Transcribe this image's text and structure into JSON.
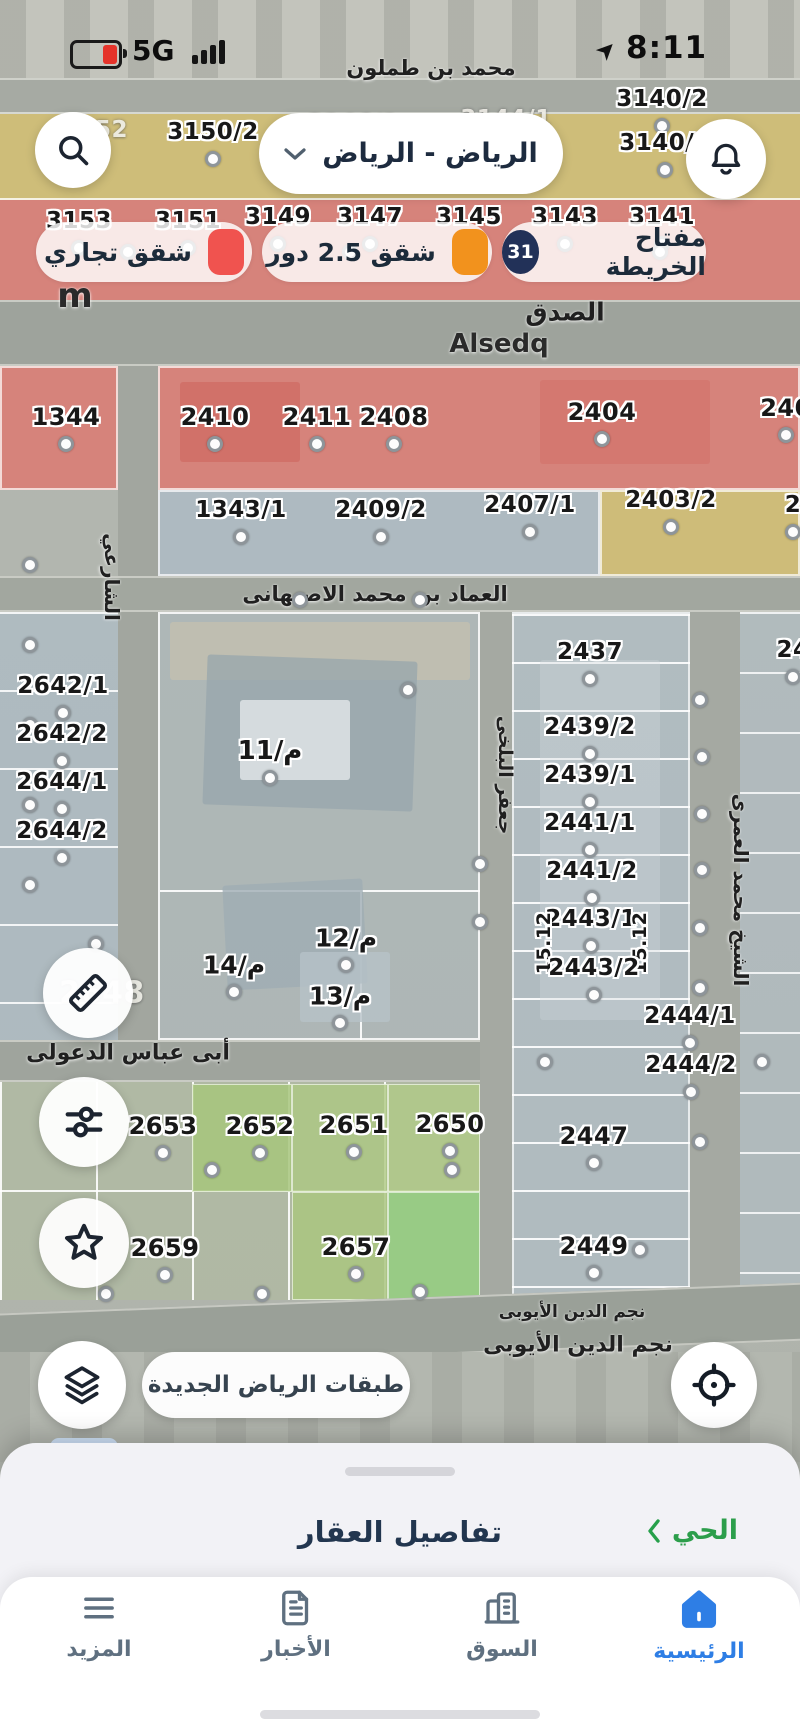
{
  "status_bar": {
    "time": "8:11",
    "network": "5G"
  },
  "header": {
    "city_selector": "الرياض - الرياض"
  },
  "legend": {
    "items": [
      {
        "label": "شقق تجاري",
        "color": "#f0534f"
      },
      {
        "label": "شقق 2.5 دور",
        "color": "#f2921d"
      }
    ],
    "map_key_label": "مفتاح الخريطة",
    "map_key_count": "31"
  },
  "colors": {
    "accent_blue": "#2e7ee5",
    "link_green": "#2c9e4b",
    "map_key_navy": "#223158"
  },
  "floating": {
    "layers_badge": "جديد",
    "layers_pill": "طبقات الرياض الجديدة"
  },
  "bottom_sheet": {
    "title": "تفاصيل العقار",
    "link": "الحي"
  },
  "bottom_nav": {
    "items": [
      {
        "id": "more",
        "label": "المزيد",
        "active": false
      },
      {
        "id": "news",
        "label": "الأخبار",
        "active": false
      },
      {
        "id": "market",
        "label": "السوق",
        "active": false
      },
      {
        "id": "home",
        "label": "الرئيسية",
        "active": true
      }
    ]
  },
  "map": {
    "street_labels": [
      {
        "t": "محمد بن طملون",
        "x": 431,
        "y": 68,
        "s": 21
      },
      {
        "t": "الصدق",
        "x": 565,
        "y": 312,
        "s": 25
      },
      {
        "t": "Alsedq",
        "x": 499,
        "y": 344,
        "s": 26,
        "latin": 1
      },
      {
        "t": "العماد بن محمد الاصبهانى",
        "x": 375,
        "y": 594,
        "s": 21
      },
      {
        "t": "الشارعي",
        "x": 112,
        "y": 577,
        "s": 20,
        "r": 90
      },
      {
        "t": "جعفر البلخى",
        "x": 505,
        "y": 775,
        "s": 19,
        "r": 90
      },
      {
        "t": "الشيخ محمد العمرى",
        "x": 741,
        "y": 890,
        "s": 20,
        "r": 90
      },
      {
        "t": "أبى عباس الدعولى",
        "x": 128,
        "y": 1053,
        "s": 22
      },
      {
        "t": "نجم الدين الأيوبى",
        "x": 572,
        "y": 1312,
        "s": 17
      },
      {
        "t": "نجم الدين الأيوبى",
        "x": 578,
        "y": 1345,
        "s": 22
      },
      {
        "t": "m",
        "x": 75,
        "y": 296,
        "s": 34,
        "latin": 1
      }
    ],
    "parcel_labels": [
      {
        "t": "3152",
        "x": 95,
        "y": 130,
        "k": "g"
      },
      {
        "t": "3150/2",
        "x": 213,
        "y": 132
      },
      {
        "t": "3146/1",
        "x": 353,
        "y": 124,
        "k": "g"
      },
      {
        "t": "3144/1",
        "x": 506,
        "y": 119,
        "k": "g"
      },
      {
        "t": "3140/2",
        "x": 662,
        "y": 99
      },
      {
        "t": "3140/1",
        "x": 665,
        "y": 143
      },
      {
        "t": "3153",
        "x": 79,
        "y": 221
      },
      {
        "t": "3151",
        "x": 188,
        "y": 221
      },
      {
        "t": "3149",
        "x": 278,
        "y": 217
      },
      {
        "t": "3147",
        "x": 370,
        "y": 217
      },
      {
        "t": "3145",
        "x": 469,
        "y": 217
      },
      {
        "t": "3143",
        "x": 565,
        "y": 217
      },
      {
        "t": "3141",
        "x": 662,
        "y": 217
      },
      {
        "t": "1344",
        "x": 66,
        "y": 417,
        "s": 24
      },
      {
        "t": "2410",
        "x": 215,
        "y": 417,
        "s": 24
      },
      {
        "t": "2411",
        "x": 317,
        "y": 417,
        "s": 24
      },
      {
        "t": "2408",
        "x": 394,
        "y": 417,
        "s": 24
      },
      {
        "t": "2404",
        "x": 602,
        "y": 412,
        "s": 24
      },
      {
        "t": "240",
        "x": 786,
        "y": 408,
        "s": 24
      },
      {
        "t": "1343/1",
        "x": 241,
        "y": 510
      },
      {
        "t": "2409/2",
        "x": 381,
        "y": 510
      },
      {
        "t": "2407/1",
        "x": 530,
        "y": 505
      },
      {
        "t": "2403/2",
        "x": 671,
        "y": 500
      },
      {
        "t": "2",
        "x": 793,
        "y": 505
      },
      {
        "t": "2642/1",
        "x": 63,
        "y": 686
      },
      {
        "t": "2642/2",
        "x": 62,
        "y": 734
      },
      {
        "t": "2644/1",
        "x": 62,
        "y": 782
      },
      {
        "t": "2644/2",
        "x": 62,
        "y": 831
      },
      {
        "t": "2437",
        "x": 590,
        "y": 652
      },
      {
        "t": "2439/2",
        "x": 590,
        "y": 727
      },
      {
        "t": "2439/1",
        "x": 590,
        "y": 775
      },
      {
        "t": "2441/1",
        "x": 590,
        "y": 823
      },
      {
        "t": "2441/2",
        "x": 592,
        "y": 871
      },
      {
        "t": "2443/1",
        "x": 591,
        "y": 919
      },
      {
        "t": "15.12",
        "x": 544,
        "y": 943,
        "k": "v",
        "s": 19
      },
      {
        "t": "15.12",
        "x": 640,
        "y": 943,
        "k": "v",
        "s": 19
      },
      {
        "t": "2443/2",
        "x": 594,
        "y": 968
      },
      {
        "t": "2444/1",
        "x": 690,
        "y": 1016
      },
      {
        "t": "2444/2",
        "x": 691,
        "y": 1065
      },
      {
        "t": "2447",
        "x": 594,
        "y": 1136,
        "s": 24
      },
      {
        "t": "2449",
        "x": 594,
        "y": 1246,
        "s": 24
      },
      {
        "t": "24",
        "x": 793,
        "y": 650
      },
      {
        "t": "2648",
        "x": 102,
        "y": 993,
        "k": "g",
        "s": 30
      },
      {
        "t": "م/11",
        "x": 270,
        "y": 751,
        "k": "m",
        "s": 26
      },
      {
        "t": "م/12",
        "x": 346,
        "y": 938,
        "k": "m",
        "s": 25
      },
      {
        "t": "م/14",
        "x": 234,
        "y": 965,
        "k": "m",
        "s": 25
      },
      {
        "t": "م/13",
        "x": 340,
        "y": 996,
        "k": "m",
        "s": 25
      },
      {
        "t": "2653",
        "x": 163,
        "y": 1126,
        "s": 24
      },
      {
        "t": "2652",
        "x": 260,
        "y": 1126,
        "s": 24
      },
      {
        "t": "2651",
        "x": 354,
        "y": 1125,
        "s": 24
      },
      {
        "t": "2650",
        "x": 450,
        "y": 1124,
        "s": 24
      },
      {
        "t": "2659",
        "x": 165,
        "y": 1248,
        "s": 24
      },
      {
        "t": "2657",
        "x": 356,
        "y": 1247,
        "s": 24
      }
    ],
    "extra_dots": [
      [
        300,
        158
      ],
      [
        425,
        162
      ],
      [
        548,
        162
      ],
      [
        128,
        252
      ],
      [
        350,
        252
      ],
      [
        660,
        252
      ],
      [
        30,
        565
      ],
      [
        30,
        645
      ],
      [
        30,
        725
      ],
      [
        30,
        805
      ],
      [
        30,
        885
      ],
      [
        96,
        944
      ],
      [
        300,
        600
      ],
      [
        420,
        600
      ],
      [
        408,
        690
      ],
      [
        700,
        700
      ],
      [
        702,
        757
      ],
      [
        702,
        814
      ],
      [
        702,
        870
      ],
      [
        700,
        928
      ],
      [
        700,
        988
      ],
      [
        762,
        1062
      ],
      [
        700,
        1142
      ],
      [
        212,
        1170
      ],
      [
        452,
        1170
      ],
      [
        106,
        1294
      ],
      [
        262,
        1294
      ],
      [
        420,
        1292
      ],
      [
        480,
        864
      ],
      [
        480,
        922
      ],
      [
        545,
        1062
      ],
      [
        640,
        1250
      ]
    ]
  }
}
